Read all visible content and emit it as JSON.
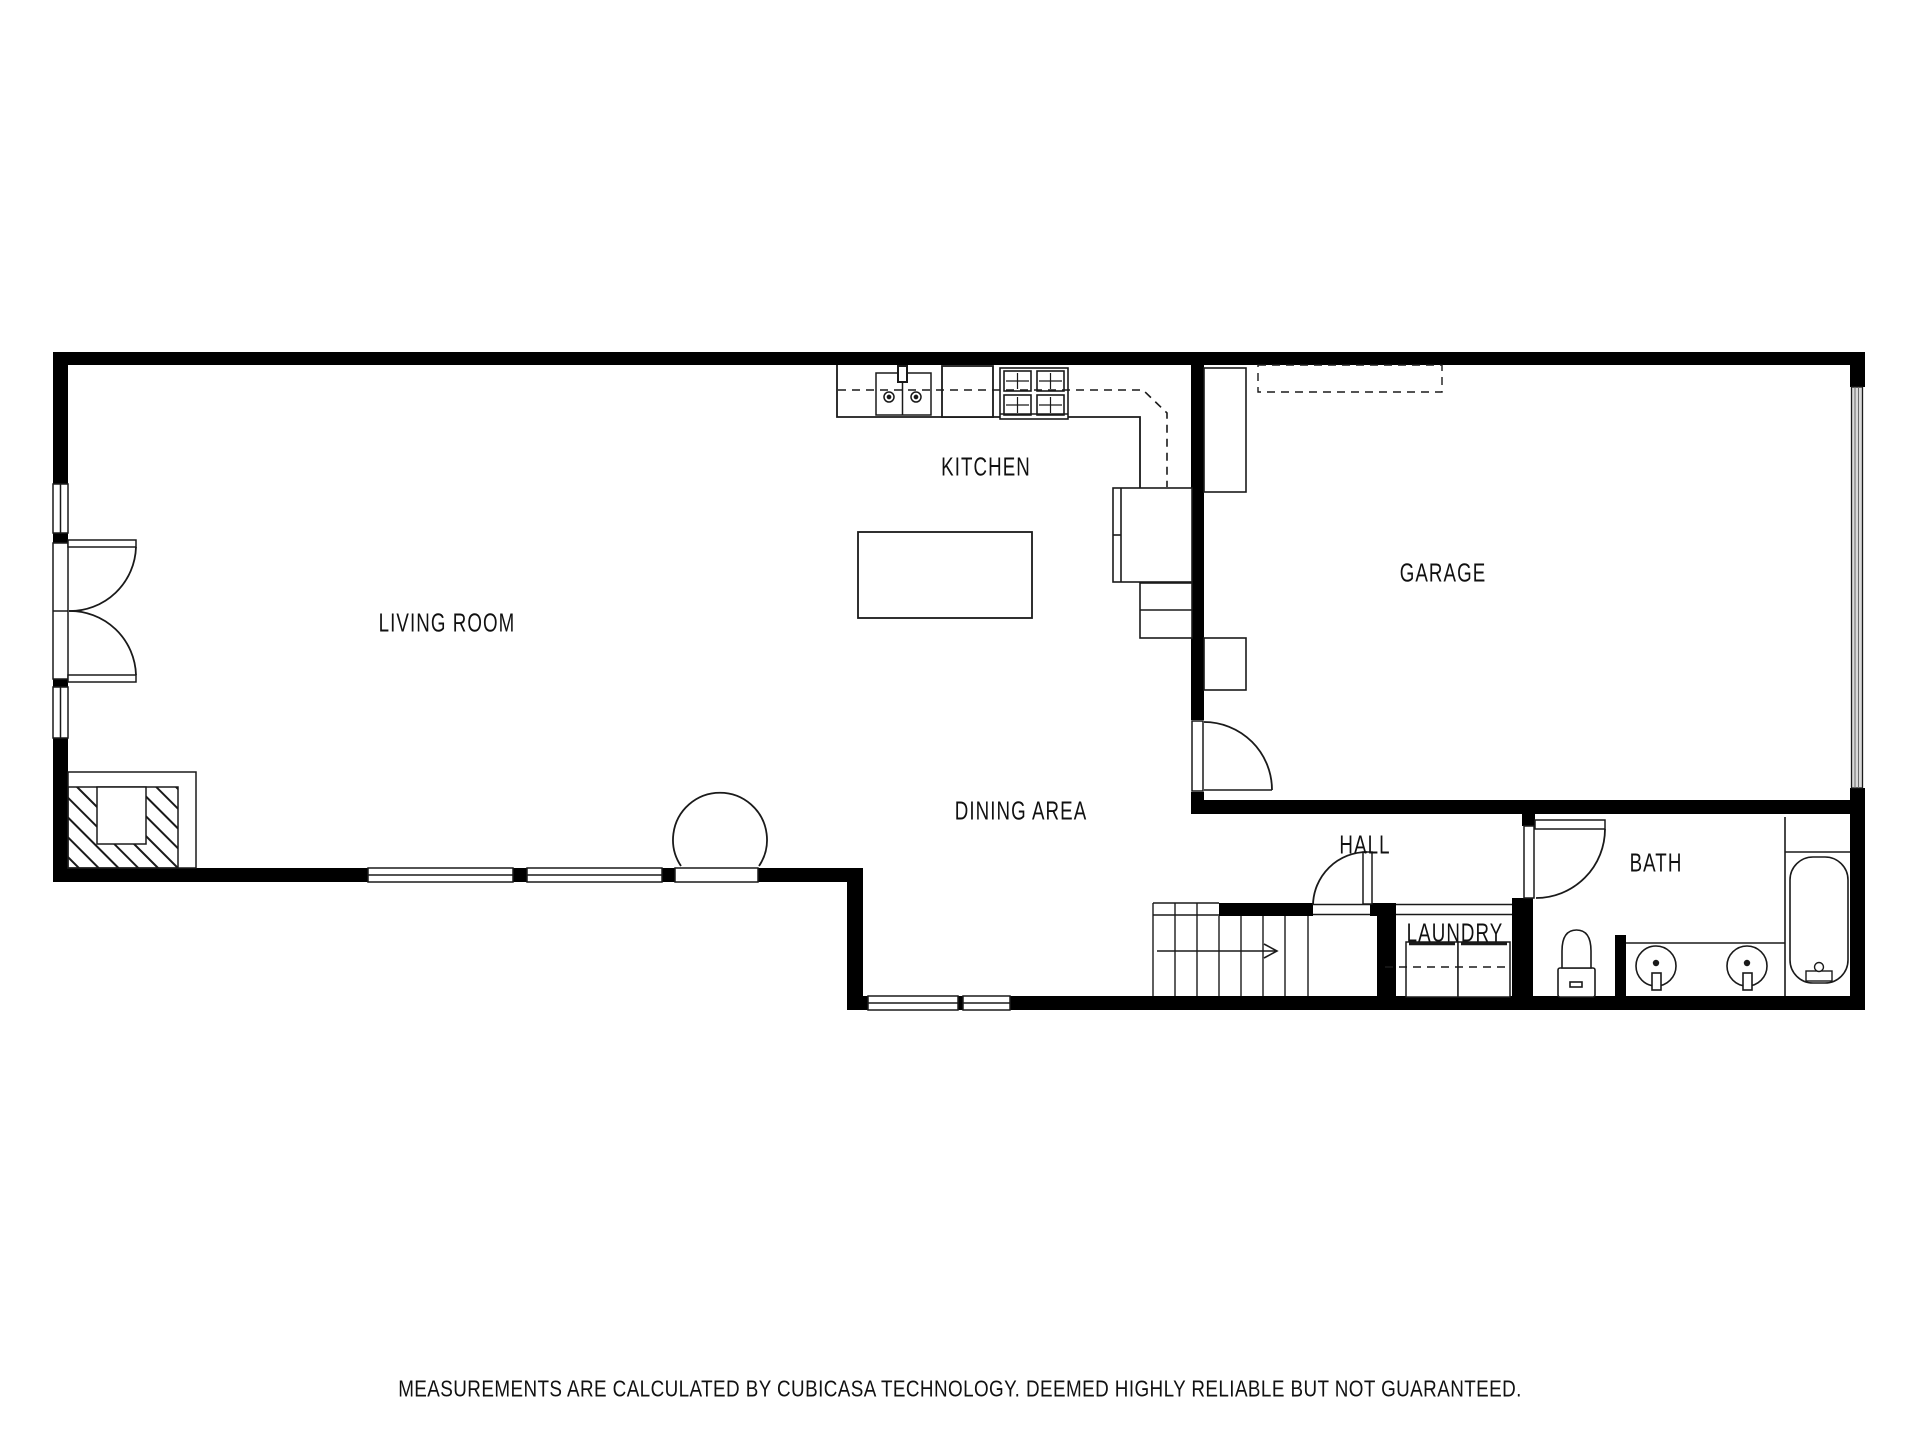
{
  "floorplan": {
    "rooms": [
      {
        "id": "living-room",
        "label": "LIVING ROOM"
      },
      {
        "id": "kitchen",
        "label": "KITCHEN"
      },
      {
        "id": "garage",
        "label": "GARAGE"
      },
      {
        "id": "dining-area",
        "label": "DINING AREA"
      },
      {
        "id": "hall",
        "label": "HALL"
      },
      {
        "id": "laundry",
        "label": "LAUNDRY"
      },
      {
        "id": "bath",
        "label": "BATH"
      }
    ],
    "disclaimer": "MEASUREMENTS ARE CALCULATED BY CUBICASA TECHNOLOGY. DEEMED HIGHLY RELIABLE BUT NOT GUARANTEED.",
    "colors": {
      "wall": "#000000",
      "line": "#1a1a1a",
      "background": "#ffffff",
      "garage_door_fill": "#d9d9d9"
    },
    "fixtures": [
      "kitchen-sink",
      "dishwasher",
      "stove",
      "refrigerator",
      "kitchen-island",
      "upper-cabinets-dashed",
      "fireplace",
      "french-doors",
      "windows",
      "stairs-with-arrow",
      "garage-vehicle-door",
      "washer",
      "dryer",
      "toilet",
      "double-vanity-sinks",
      "bathtub"
    ]
  }
}
